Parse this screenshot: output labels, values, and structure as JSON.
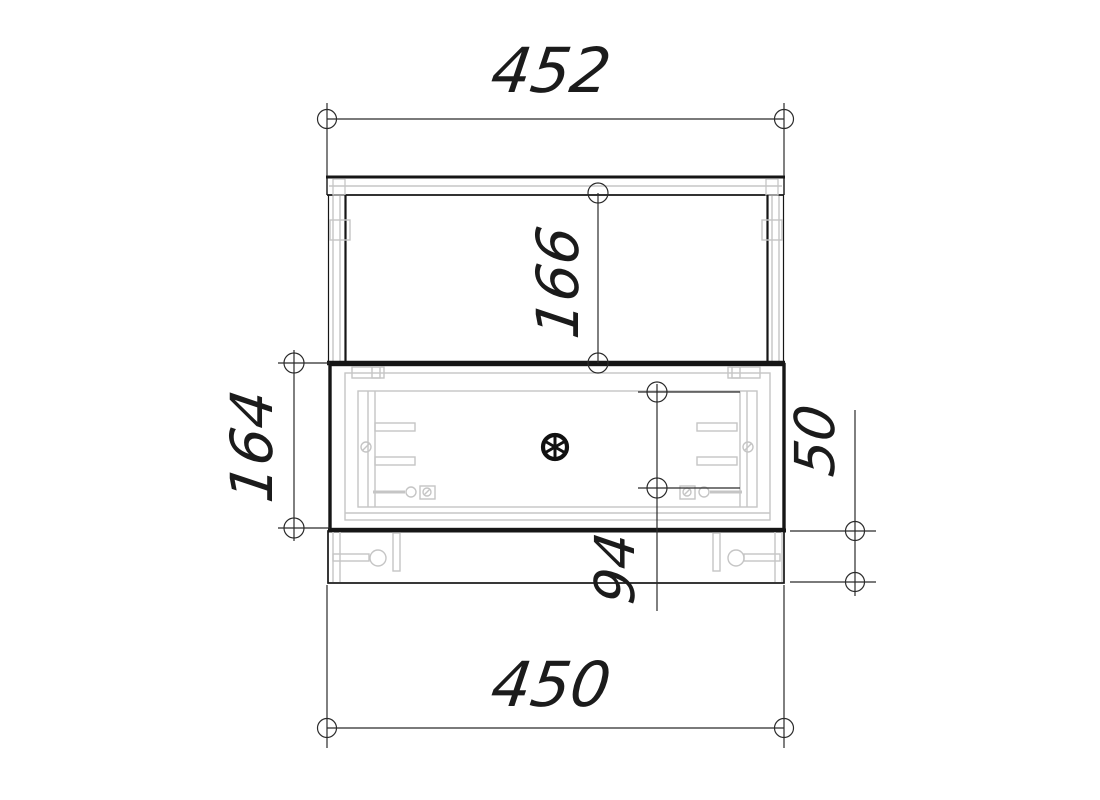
{
  "drawing": {
    "type": "cabinet-drawer-top-view-technical-drawing",
    "dimensions": {
      "top_overall_width": "452",
      "upper_section_depth": "166",
      "drawer_section_depth": "164",
      "inner_drawer_span": "94",
      "rear_rail_depth": "50",
      "bottom_overall_width": "450"
    },
    "colors": {
      "outline": "#1a1a1a",
      "dimension_line": "#2b2b2b",
      "hardware": "#c5c5c5",
      "background": "#ffffff"
    }
  }
}
